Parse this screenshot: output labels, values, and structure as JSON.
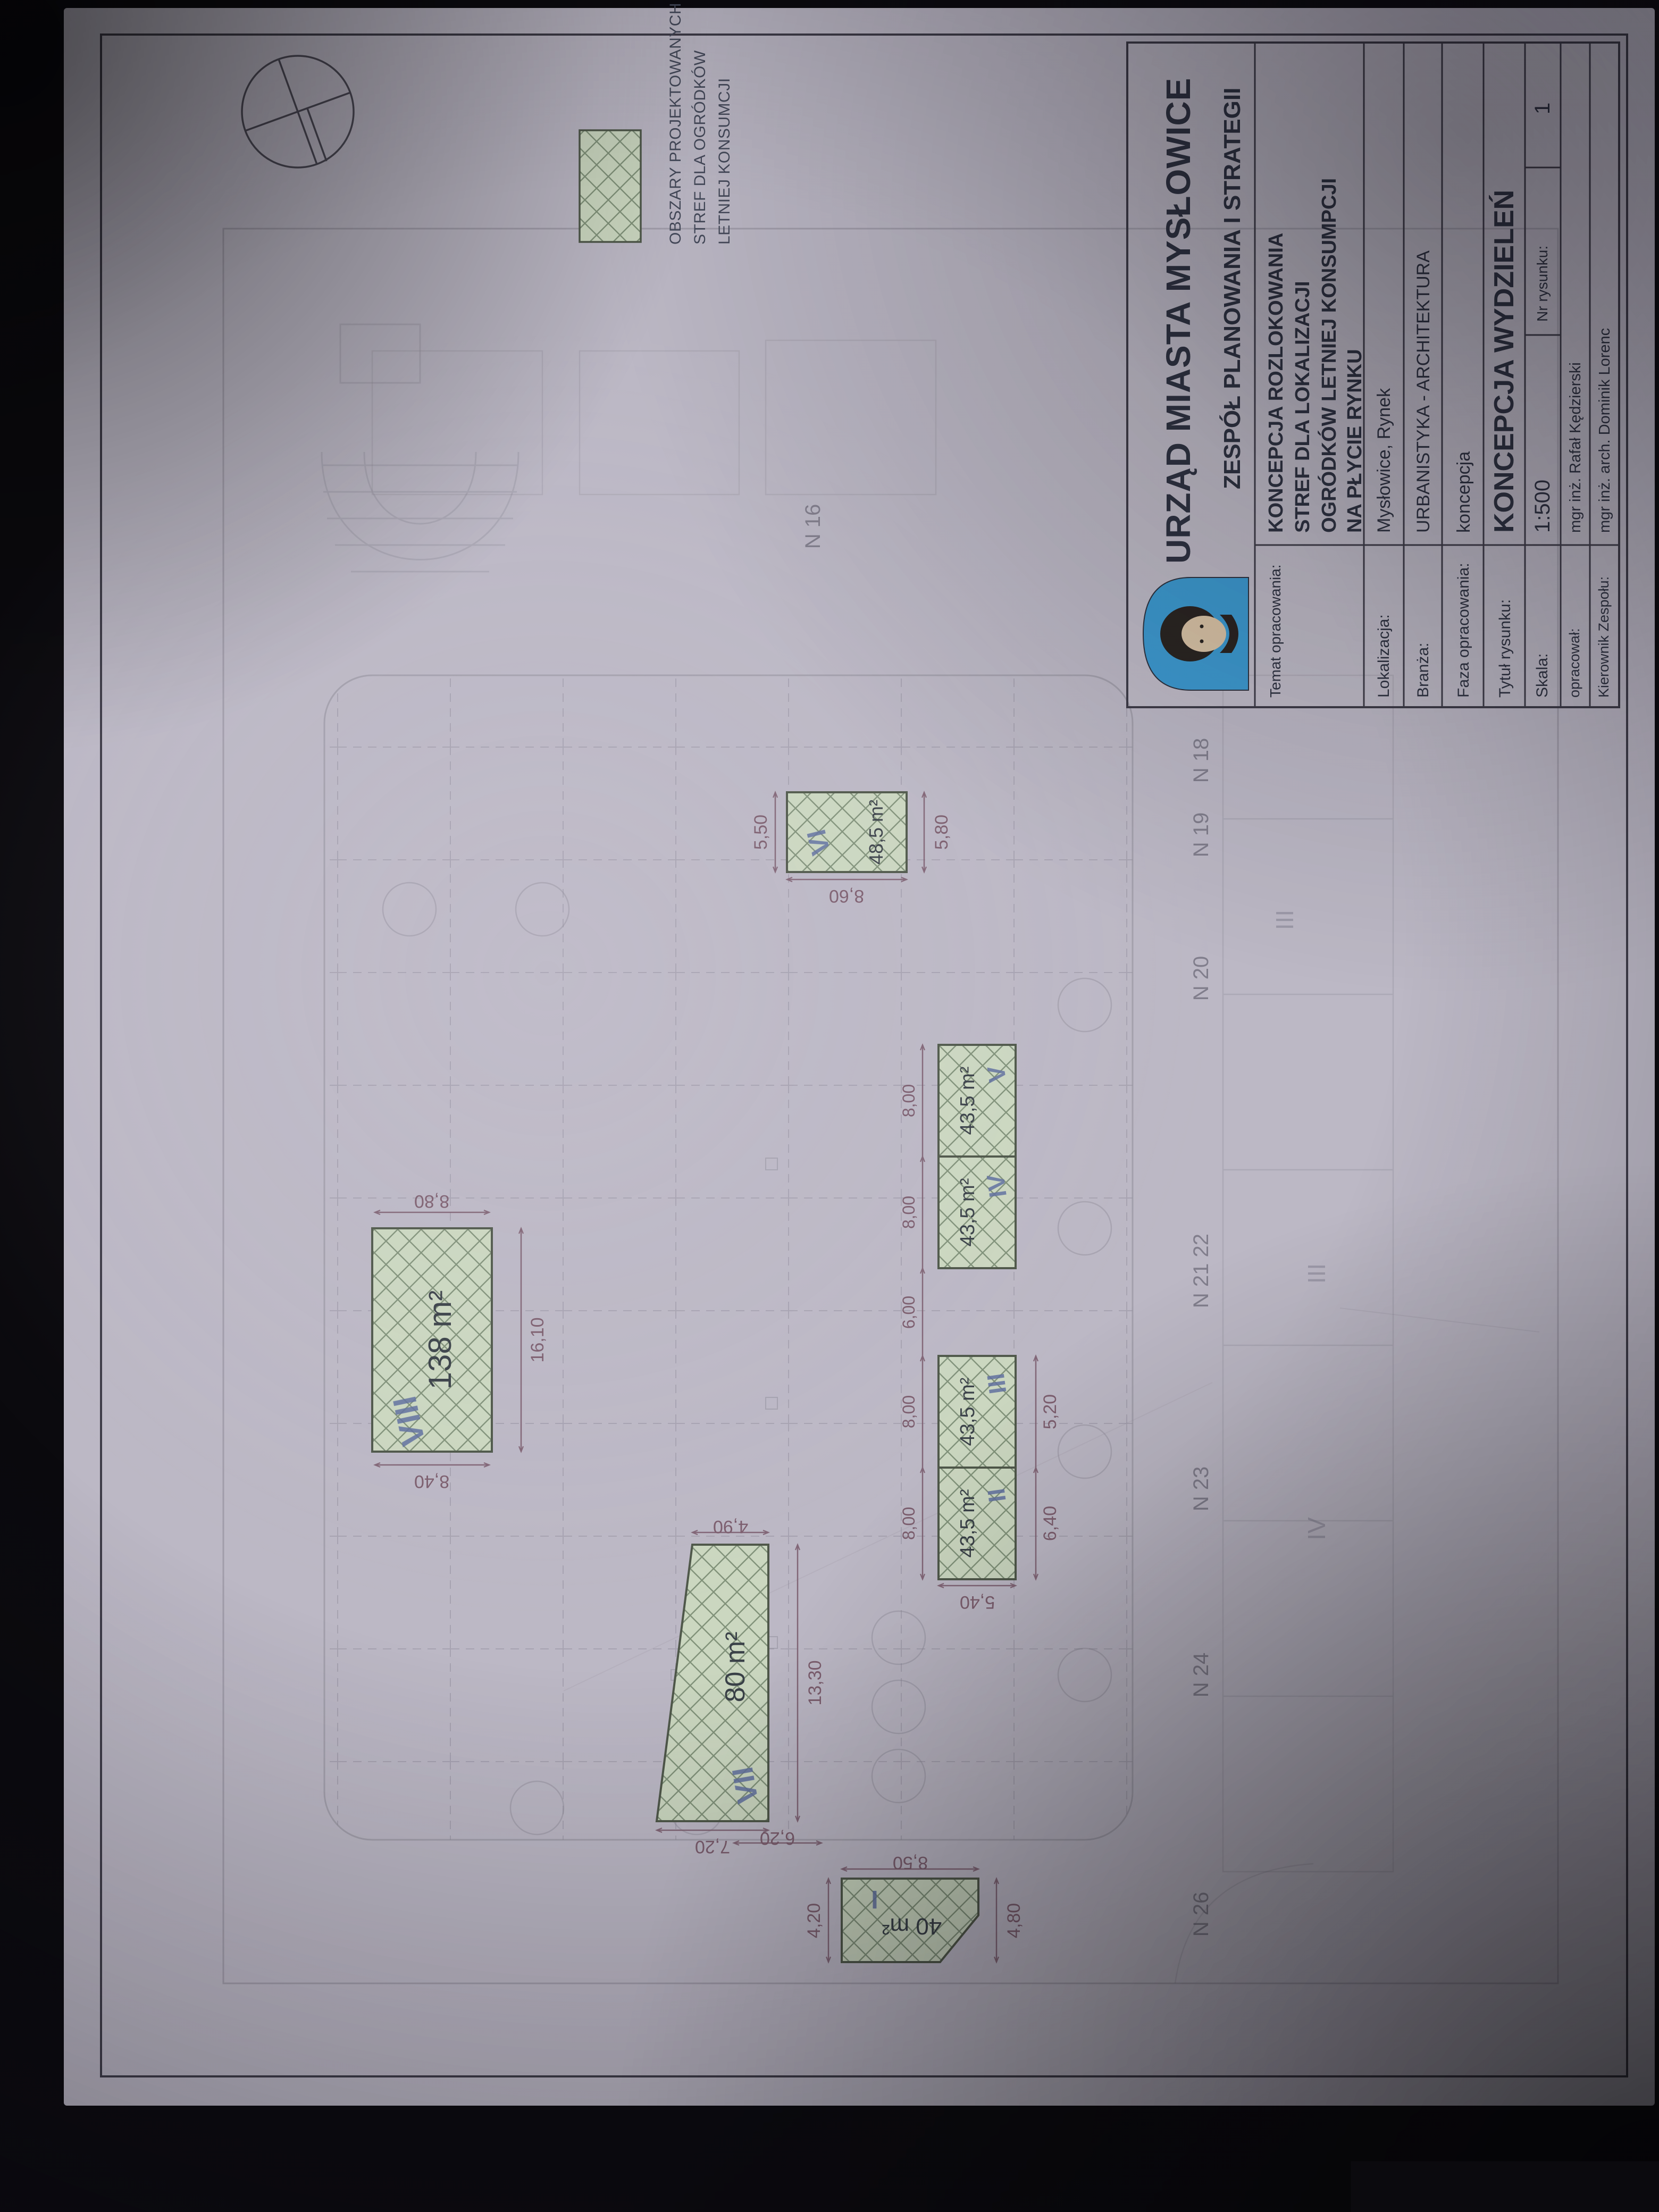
{
  "document": {
    "kind": "photographed architectural site plan, rotated 90 degrees",
    "scale_note": "1:500"
  },
  "colors": {
    "photo_bg": "#0b0a0e",
    "paper": "#bcb8c5",
    "ink": "#2f3342",
    "faint_line": "#8a8794",
    "zone_fill": "#cbd7c0",
    "zone_hatch": "#81927a",
    "zone_border": "#4f584a",
    "dimension": "#7c5e6e",
    "numeral_blue": "#5f6f9e",
    "logo_blue": "#3d9ad0"
  },
  "legend": {
    "lines": [
      "OBSZARY PROJEKTOWANYCH",
      "STREF DLA OGRÓDKÓW",
      "LETNIEJ KONSUMCJI"
    ]
  },
  "zones": [
    {
      "numeral": "I",
      "area": "40 m²",
      "dims": [
        "4,20",
        "4,80",
        "8,50",
        "6,20"
      ]
    },
    {
      "numeral": "II",
      "area": "43,5 m²",
      "dims": []
    },
    {
      "numeral": "III",
      "area": "43,5 m²",
      "dims": []
    },
    {
      "numeral": "IV",
      "area": "43,5 m²",
      "dims": []
    },
    {
      "numeral": "V",
      "area": "43,5 m²",
      "dims": []
    },
    {
      "numeral": "VI",
      "area": "48,5 m²",
      "dims": [
        "5,50",
        "5,80",
        "8,60"
      ]
    },
    {
      "numeral": "VII",
      "area": "80 m²",
      "dims": [
        "4,90",
        "7,20",
        "13,30"
      ]
    },
    {
      "numeral": "VIII",
      "area": "138 m²",
      "dims": [
        "8,80",
        "8,40",
        "16,10"
      ]
    }
  ],
  "row_dims": [
    "8,00",
    "8,00",
    "6,00",
    "8,00",
    "8,00",
    "5,40",
    "6,40",
    "5,20"
  ],
  "plot_labels": [
    "N 26",
    "N 24",
    "N 23",
    "N 21 22",
    "N 20",
    "N 19",
    "N 18",
    "N 16"
  ],
  "faint_numerals": [
    "III",
    "III",
    "IV"
  ],
  "title_block": {
    "office": "URZĄD MIASTA MYSŁOWICE",
    "team": "ZESPÓŁ PLANOWANIA I STRATEGII",
    "temat_label": "Temat opracowania:",
    "temat_lines": [
      "KONCEPCJA ROZLOKOWANIA",
      "STREF DLA LOKALIZACJI",
      "OGRÓDKÓW LETNIEJ KONSUMPCJI",
      "NA PŁYCIE RYNKU"
    ],
    "lokalizacja_label": "Lokalizacja:",
    "lokalizacja_value": "Mysłowice, Rynek",
    "branza_label": "Branża:",
    "branza_value": "URBANISTYKA - ARCHITEKTURA",
    "faza_label": "Faza opracowania:",
    "faza_value": "koncepcja",
    "tytul_label": "Tytuł rysunku:",
    "tytul_value": "KONCEPCJA WYDZIELEŃ",
    "skala_label": "Skala:",
    "skala_value": "1:500",
    "nr_label": "Nr rysunku:",
    "nr_value": "1",
    "opracowal_label": "opracował:",
    "opracowal_value": "mgr inż. Rafał Kędzierski",
    "kierownik_label": "Kierownik Zespołu:",
    "kierownik_value": "mgr inż. arch. Dominik Lorenc"
  }
}
